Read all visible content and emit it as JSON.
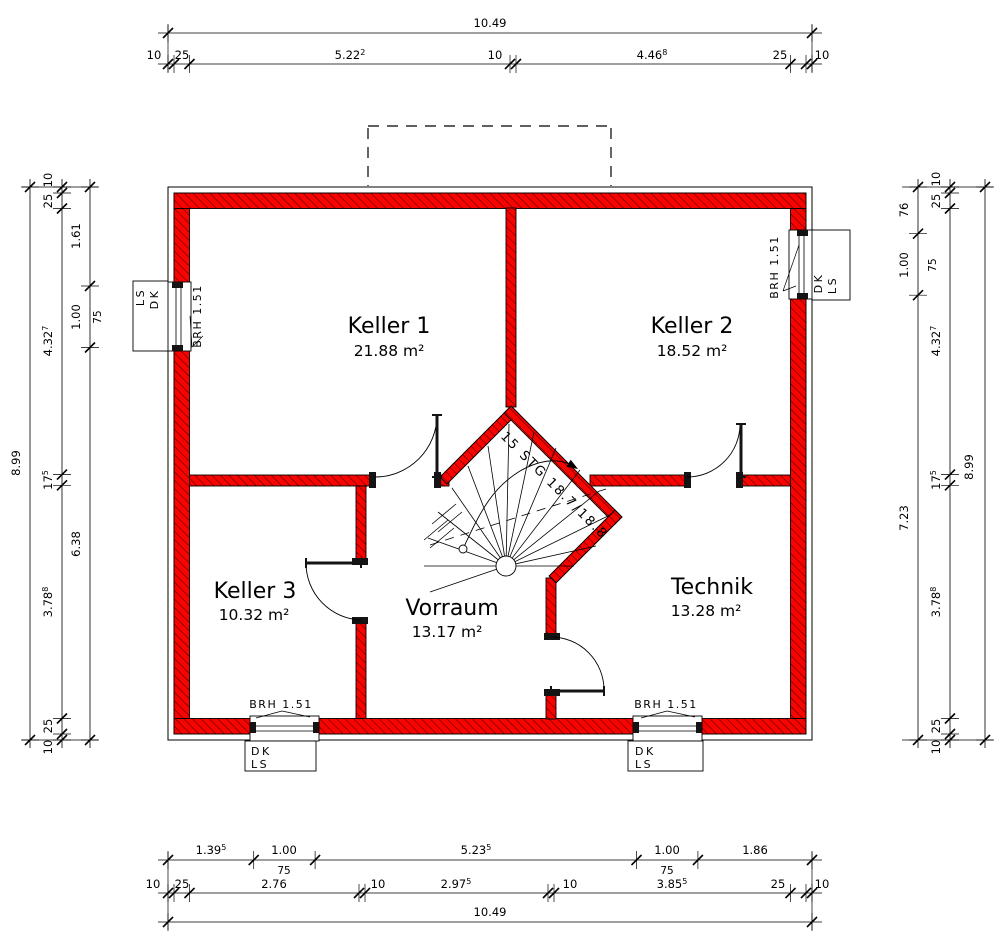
{
  "plan": {
    "rooms": [
      {
        "name": "Keller 1",
        "area": "21.88 m²"
      },
      {
        "name": "Keller 2",
        "area": "18.52 m²"
      },
      {
        "name": "Keller 3",
        "area": "10.32 m²"
      },
      {
        "name": "Vorraum",
        "area": "13.17 m²"
      },
      {
        "name": "Technik",
        "area": "13.28 m²"
      }
    ],
    "stair": {
      "label": "15 STG 18.7/18.8"
    },
    "window": {
      "brh": "BRH 1.51",
      "height_label": "75",
      "left_box": {
        "l1": "LS",
        "l2": "DK"
      },
      "right_box": {
        "l1": "DK",
        "l2": "LS"
      },
      "bottom_box": {
        "l1": "DK",
        "l2": "LS"
      }
    },
    "dims": {
      "top": {
        "total": "10.49",
        "chain": [
          {
            "v": "10"
          },
          {
            "v": "25"
          },
          {
            "v": "5.22",
            "s": "2"
          },
          {
            "v": "10"
          },
          {
            "v": "4.46",
            "s": "8"
          },
          {
            "v": "25"
          },
          {
            "v": "10"
          }
        ]
      },
      "bottom": {
        "total": "10.49",
        "openings": [
          {
            "v": "1.39",
            "s": "5"
          },
          {
            "v": "1.00"
          },
          {
            "v": "5.23",
            "s": "5"
          },
          {
            "v": "1.00"
          },
          {
            "v": "1.86"
          }
        ],
        "chain": [
          {
            "v": "10"
          },
          {
            "v": "25"
          },
          {
            "v": "2.76"
          },
          {
            "v": "10"
          },
          {
            "v": "2.97",
            "s": "5"
          },
          {
            "v": "10"
          },
          {
            "v": "3.85",
            "s": "5"
          },
          {
            "v": "25"
          },
          {
            "v": "10"
          }
        ]
      },
      "left": {
        "total": "8.99",
        "chain": [
          {
            "v": "10"
          },
          {
            "v": "25"
          },
          {
            "v": "4.32",
            "s": "7"
          },
          {
            "v": "17",
            "s": "5"
          },
          {
            "v": "3.78",
            "s": "8"
          },
          {
            "v": "25"
          },
          {
            "v": "10"
          }
        ],
        "inner": [
          {
            "v": "1.61"
          },
          {
            "v": "1.00"
          },
          {
            "v": "6.38"
          }
        ]
      },
      "right": {
        "total": "8.99",
        "chain": [
          {
            "v": "10"
          },
          {
            "v": "25"
          },
          {
            "v": "4.32",
            "s": "7"
          },
          {
            "v": "17",
            "s": "5"
          },
          {
            "v": "3.78",
            "s": "8"
          },
          {
            "v": "25"
          },
          {
            "v": "10"
          }
        ],
        "inner": [
          {
            "v": "76"
          },
          {
            "v": "1.00"
          },
          {
            "v": "7.23"
          }
        ]
      }
    }
  }
}
